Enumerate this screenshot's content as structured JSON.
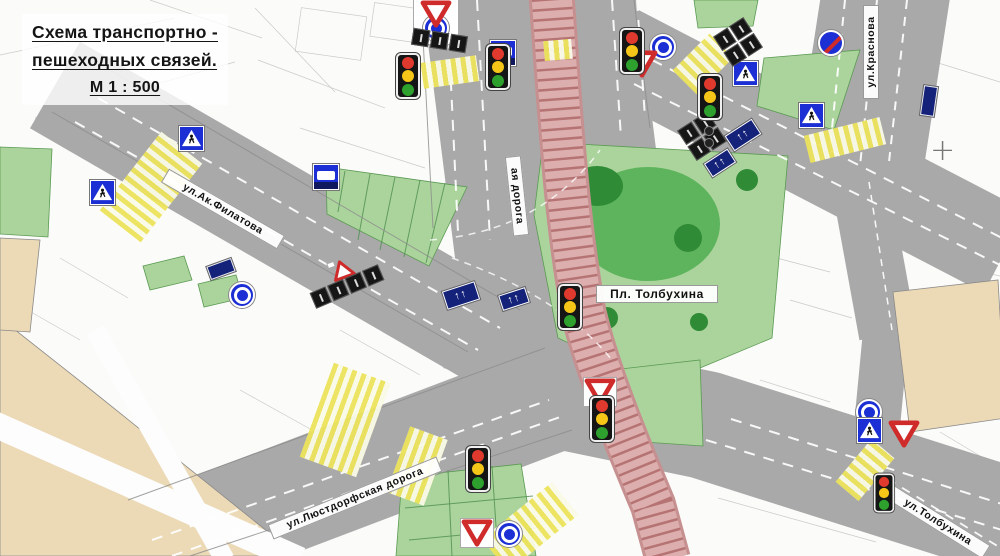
{
  "title": {
    "line1": "Схема транспортно -",
    "line2": "пешеходных связей.",
    "scale": "М 1 : 500"
  },
  "streets": {
    "filatova": "ул.Ак.Филатова",
    "krasnova": "ул.Краснова",
    "lustdorf": "ул.Люстдорфская дорога",
    "tolbukhina_street": "ул.Толбухина",
    "doroga_fragment": "ая дорога"
  },
  "places": {
    "tolbukhina_square": "Пл. Толбухина"
  },
  "marks": {
    "survey_cross": "+"
  },
  "icons": {
    "traffic_light": "three-lamp-signal",
    "roundabout": "blue-circle-with-white-ring-arrows",
    "yield": "inverted-white-triangle-red-border",
    "pedestrian_crossing": "blue-square-walking-person-triangle",
    "bus_stop": "blue-square-with-bus",
    "no_stopping": "blue-circle-red-slash",
    "lane_direction_arrows": "↑↑",
    "warning_triangle": "red-outline-triangle-on-white"
  },
  "colors": {
    "road": "#a9a9a9",
    "green_light": "#abd49c",
    "green_mid": "#5db45c",
    "green_dark": "#2f8b36",
    "crosswalk_yellow": "#ebe35a",
    "tram_pink": "#dcaeae",
    "tram_tie": "#a95f5f",
    "sign_blue": "#1b2fd4",
    "sign_navy": "#14227a",
    "sign_red": "#cf2b2b",
    "building_tan": "#ecd9b6",
    "traffic_red": "#e03a2f",
    "traffic_yellow": "#f5c518",
    "traffic_green": "#2da02d"
  }
}
